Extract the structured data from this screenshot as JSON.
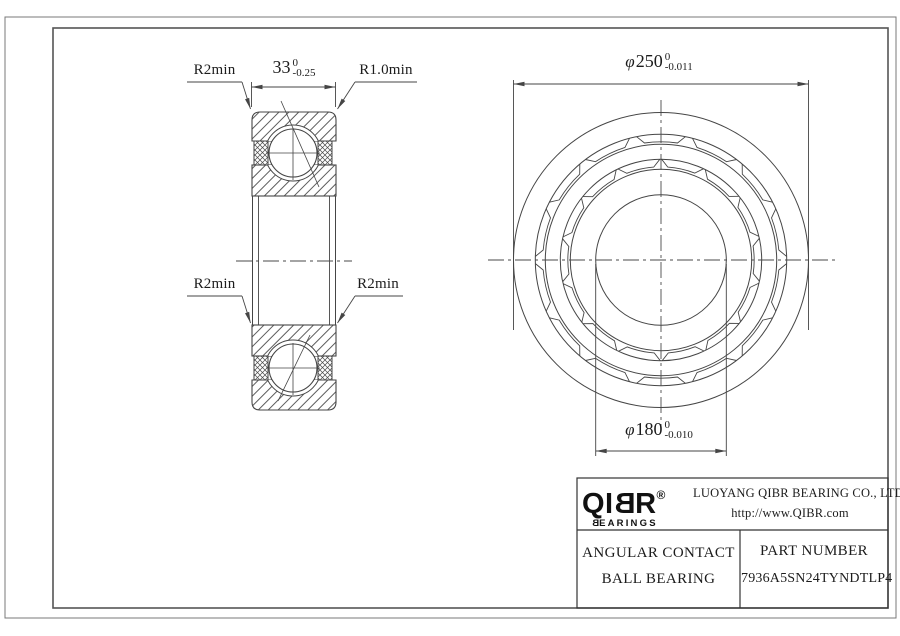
{
  "callouts": {
    "top_left": "R2min",
    "top_right": "R1.0min",
    "bottom_left": "R2min",
    "bottom_right": "R2min"
  },
  "dimensions": {
    "width": {
      "value": "33",
      "tol_up": "0",
      "tol_down": "-0.25"
    },
    "outer_diameter": {
      "prefix": "φ",
      "value": "250",
      "tol_up": "0",
      "tol_down": "-0.011"
    },
    "bore_diameter": {
      "prefix": "φ",
      "value": "180",
      "tol_up": "0",
      "tol_down": "-0.010"
    }
  },
  "title_block": {
    "logo": {
      "p1": "QI",
      "p2": "B",
      "p3": "R",
      "reg": "®",
      "sub1": "B",
      "sub2": "EARINGS"
    },
    "company_line1": "LUOYANG QIBR BEARING CO., LTD",
    "company_line2": "http://www.QIBR.com",
    "product_line1": "ANGULAR CONTACT",
    "product_line2": "BALL BEARING",
    "part_label": "PART NUMBER",
    "part_number": "7936A5SN24TYNDTLP4"
  },
  "colors": {
    "line": "#454545",
    "frame": "#555555",
    "text": "#1c1c1c"
  }
}
